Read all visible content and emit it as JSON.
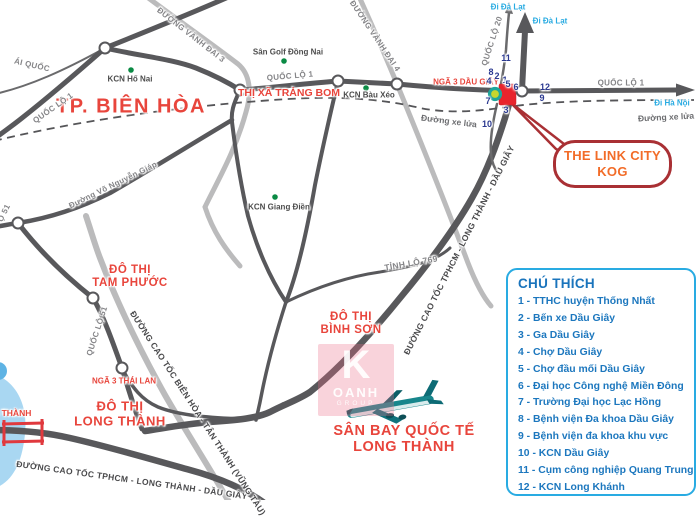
{
  "places": {
    "bien_hoa": "TP. BIÊN HÒA",
    "trang_bom": "THỊ XÃ TRẢNG BOM",
    "tam_phuoc_1": "ĐÔ THỊ",
    "tam_phuoc_2": "TAM PHƯỚC",
    "binh_son_1": "ĐÔ THỊ",
    "binh_son_2": "BÌNH SƠN",
    "long_thanh_1": "ĐÔ THỊ",
    "long_thanh_2": "LONG THÀNH",
    "san_bay_1": "SÂN BAY QUỐC TẾ",
    "san_bay_2": "LONG THÀNH",
    "nga3_dau_giay": "NGÃ 3 DẦU GIÂY",
    "nga3_thai_lan": "NGÃ 3 THÁI LAN",
    "thanh_fragment": "G THÀNH"
  },
  "pois": {
    "kcn_ho_nai": "KCN Hố Nai",
    "san_golf": "Sân Golf Đồng Nai",
    "kcn_bau_xeo": "KCN Bàu Xéo",
    "kcn_giang_dien": "KCN Giang Điền"
  },
  "roads": {
    "ai_quoc": "ÁI QUỐC",
    "ql1_a": "QUỐC LỘ 1",
    "ql1_b": "QUỐC LỘ 1",
    "ql1_c": "QUỐC LỘ 1",
    "ql20": "QUỐC LỘ 20",
    "ql51": "QUỐC LỘ 51",
    "lo51_fragment": "Ộ 51",
    "vanh_dai_3": "ĐƯỜNG VÀNH ĐAI 3",
    "vanh_dai_4": "ĐƯỜNG VÀNH ĐAI 4",
    "vo_nguyen_giap": "Đường Võ Nguyễn Giáp",
    "tinh_lo_769": "TỈNH LỘ 769",
    "cao_toc_hld_bottom": "ĐƯỜNG CAO TỐC TPHCM - LONG THÀNH - DẦU GIÂY",
    "cao_toc_hld_ne": "ĐƯỜNG CAO TỐC TPHCM - LONG THÀNH - DẦU GIÂY",
    "cao_toc_bh_tt": "ĐƯỜNG CAO TỐC BIÊN HÒA - TÂN THÀNH (VŨNG TÀU)",
    "xe_lua_a": "Đường xe lửa",
    "xe_lua_b": "Đường xe lửa"
  },
  "directions": {
    "da_lat_a": "Đi Đà Lạt",
    "da_lat_b": "Đi Đà Lạt",
    "ha_noi": "Đi Hà Nội"
  },
  "markers": {
    "n1": "1",
    "n2": "2",
    "n3": "3",
    "n4": "4",
    "n5": "5",
    "n6": "6",
    "n7": "7",
    "n8": "8",
    "n9": "9",
    "n10": "10",
    "n11": "11",
    "n12": "12"
  },
  "callout": {
    "line1": "THE LINK CITY",
    "line2": "KOG"
  },
  "legend": {
    "title": "CHÚ THÍCH",
    "items": [
      "1 - TTHC huyện Thống Nhất",
      "2 - Bến xe Dầu Giây",
      "3 - Ga Dầu Giây",
      "4 - Chợ Dầu Giây",
      "5 - Chợ đầu mối Dầu Giây",
      "6 - Đại học Công nghệ Miền Đông",
      "7 - Trường Đại học Lạc Hồng",
      "8 - Bệnh viện Đa khoa Dầu Giây",
      "9 - Bệnh viện đa khoa khu vực",
      "10 - KCN Dầu Giây",
      "11 - Cụm công nghiệp Quang Trung",
      "12 - KCN Long Khánh"
    ]
  },
  "watermark": {
    "letter": "K",
    "name": "OANH",
    "sub": "GROUP"
  },
  "colors": {
    "red_label": "#E8453C",
    "legend_blue": "#1C77BE",
    "direction_cyan": "#29ABE2",
    "marker_red": "#E8242C",
    "callout_orange": "#F26C28",
    "road_dark": "#58585B",
    "road_light": "#B8B8B8",
    "poi_green": "#0A8A44"
  }
}
